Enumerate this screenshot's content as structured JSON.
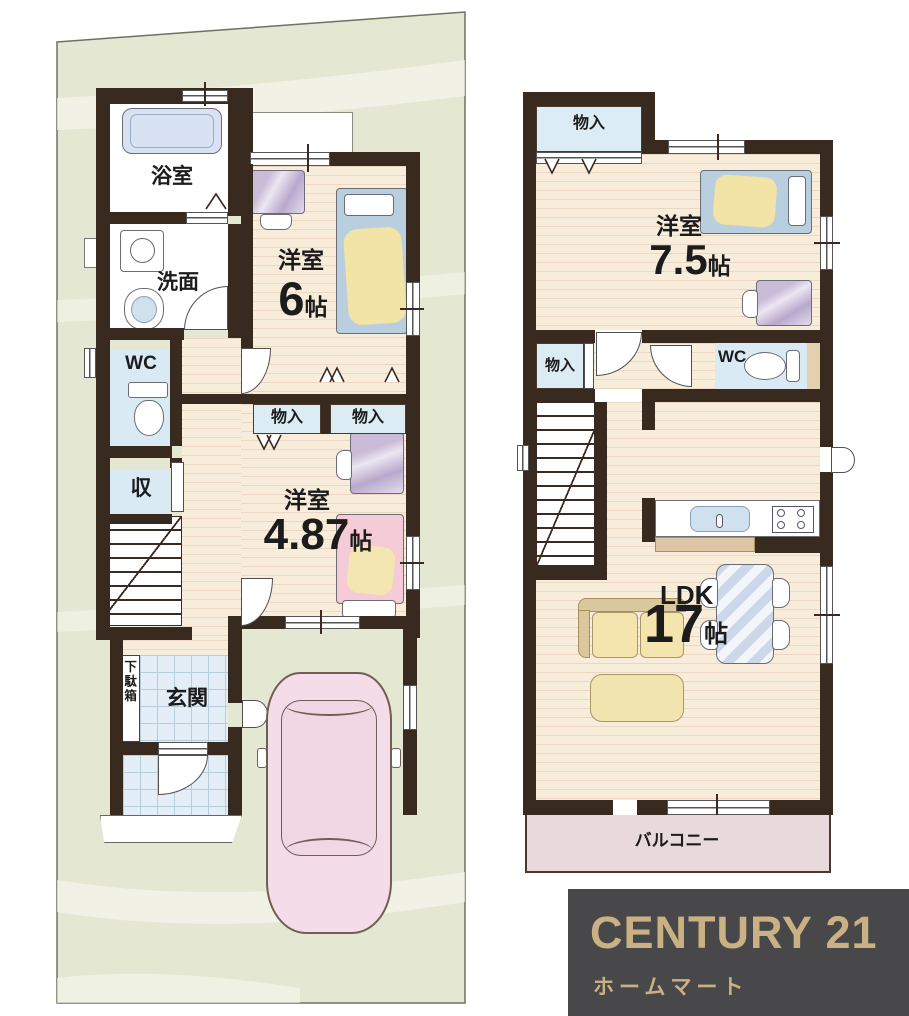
{
  "palette": {
    "site_green": "#e4e8d3",
    "wall_brown": "#392a20",
    "floor_cream": "#f8ecdb",
    "wet_room_blue": "#daeaf4",
    "balcony_pink": "#e8d9dc",
    "car_pink": "#f4dde8",
    "logo_bg": "#48484b",
    "logo_gold": "#c9b183"
  },
  "floor1": {
    "bath": {
      "label": "浴室"
    },
    "washroom": {
      "label": "洗面"
    },
    "wc": {
      "label": "WC"
    },
    "storage": {
      "label": "収"
    },
    "shoe_cabinet": {
      "label": "下駄箱"
    },
    "entrance": {
      "label": "玄関"
    },
    "bedroom_a": {
      "label": "洋室",
      "area": "6",
      "unit": "帖"
    },
    "closet_a": {
      "label": "物入"
    },
    "closet_b": {
      "label": "物入"
    },
    "bedroom_b": {
      "label": "洋室",
      "area": "4.87",
      "unit": "帖"
    }
  },
  "floor2": {
    "closet_top": {
      "label": "物入"
    },
    "bedroom": {
      "label": "洋室",
      "area": "7.5",
      "unit": "帖"
    },
    "closet_mid": {
      "label": "物入"
    },
    "wc": {
      "label": "WC"
    },
    "ldk": {
      "label": "LDK",
      "area": "17",
      "unit": "帖"
    },
    "balcony": {
      "label": "バルコニー"
    }
  },
  "logo": {
    "brand": "CENTURY 21",
    "shop": "ホームマート"
  }
}
